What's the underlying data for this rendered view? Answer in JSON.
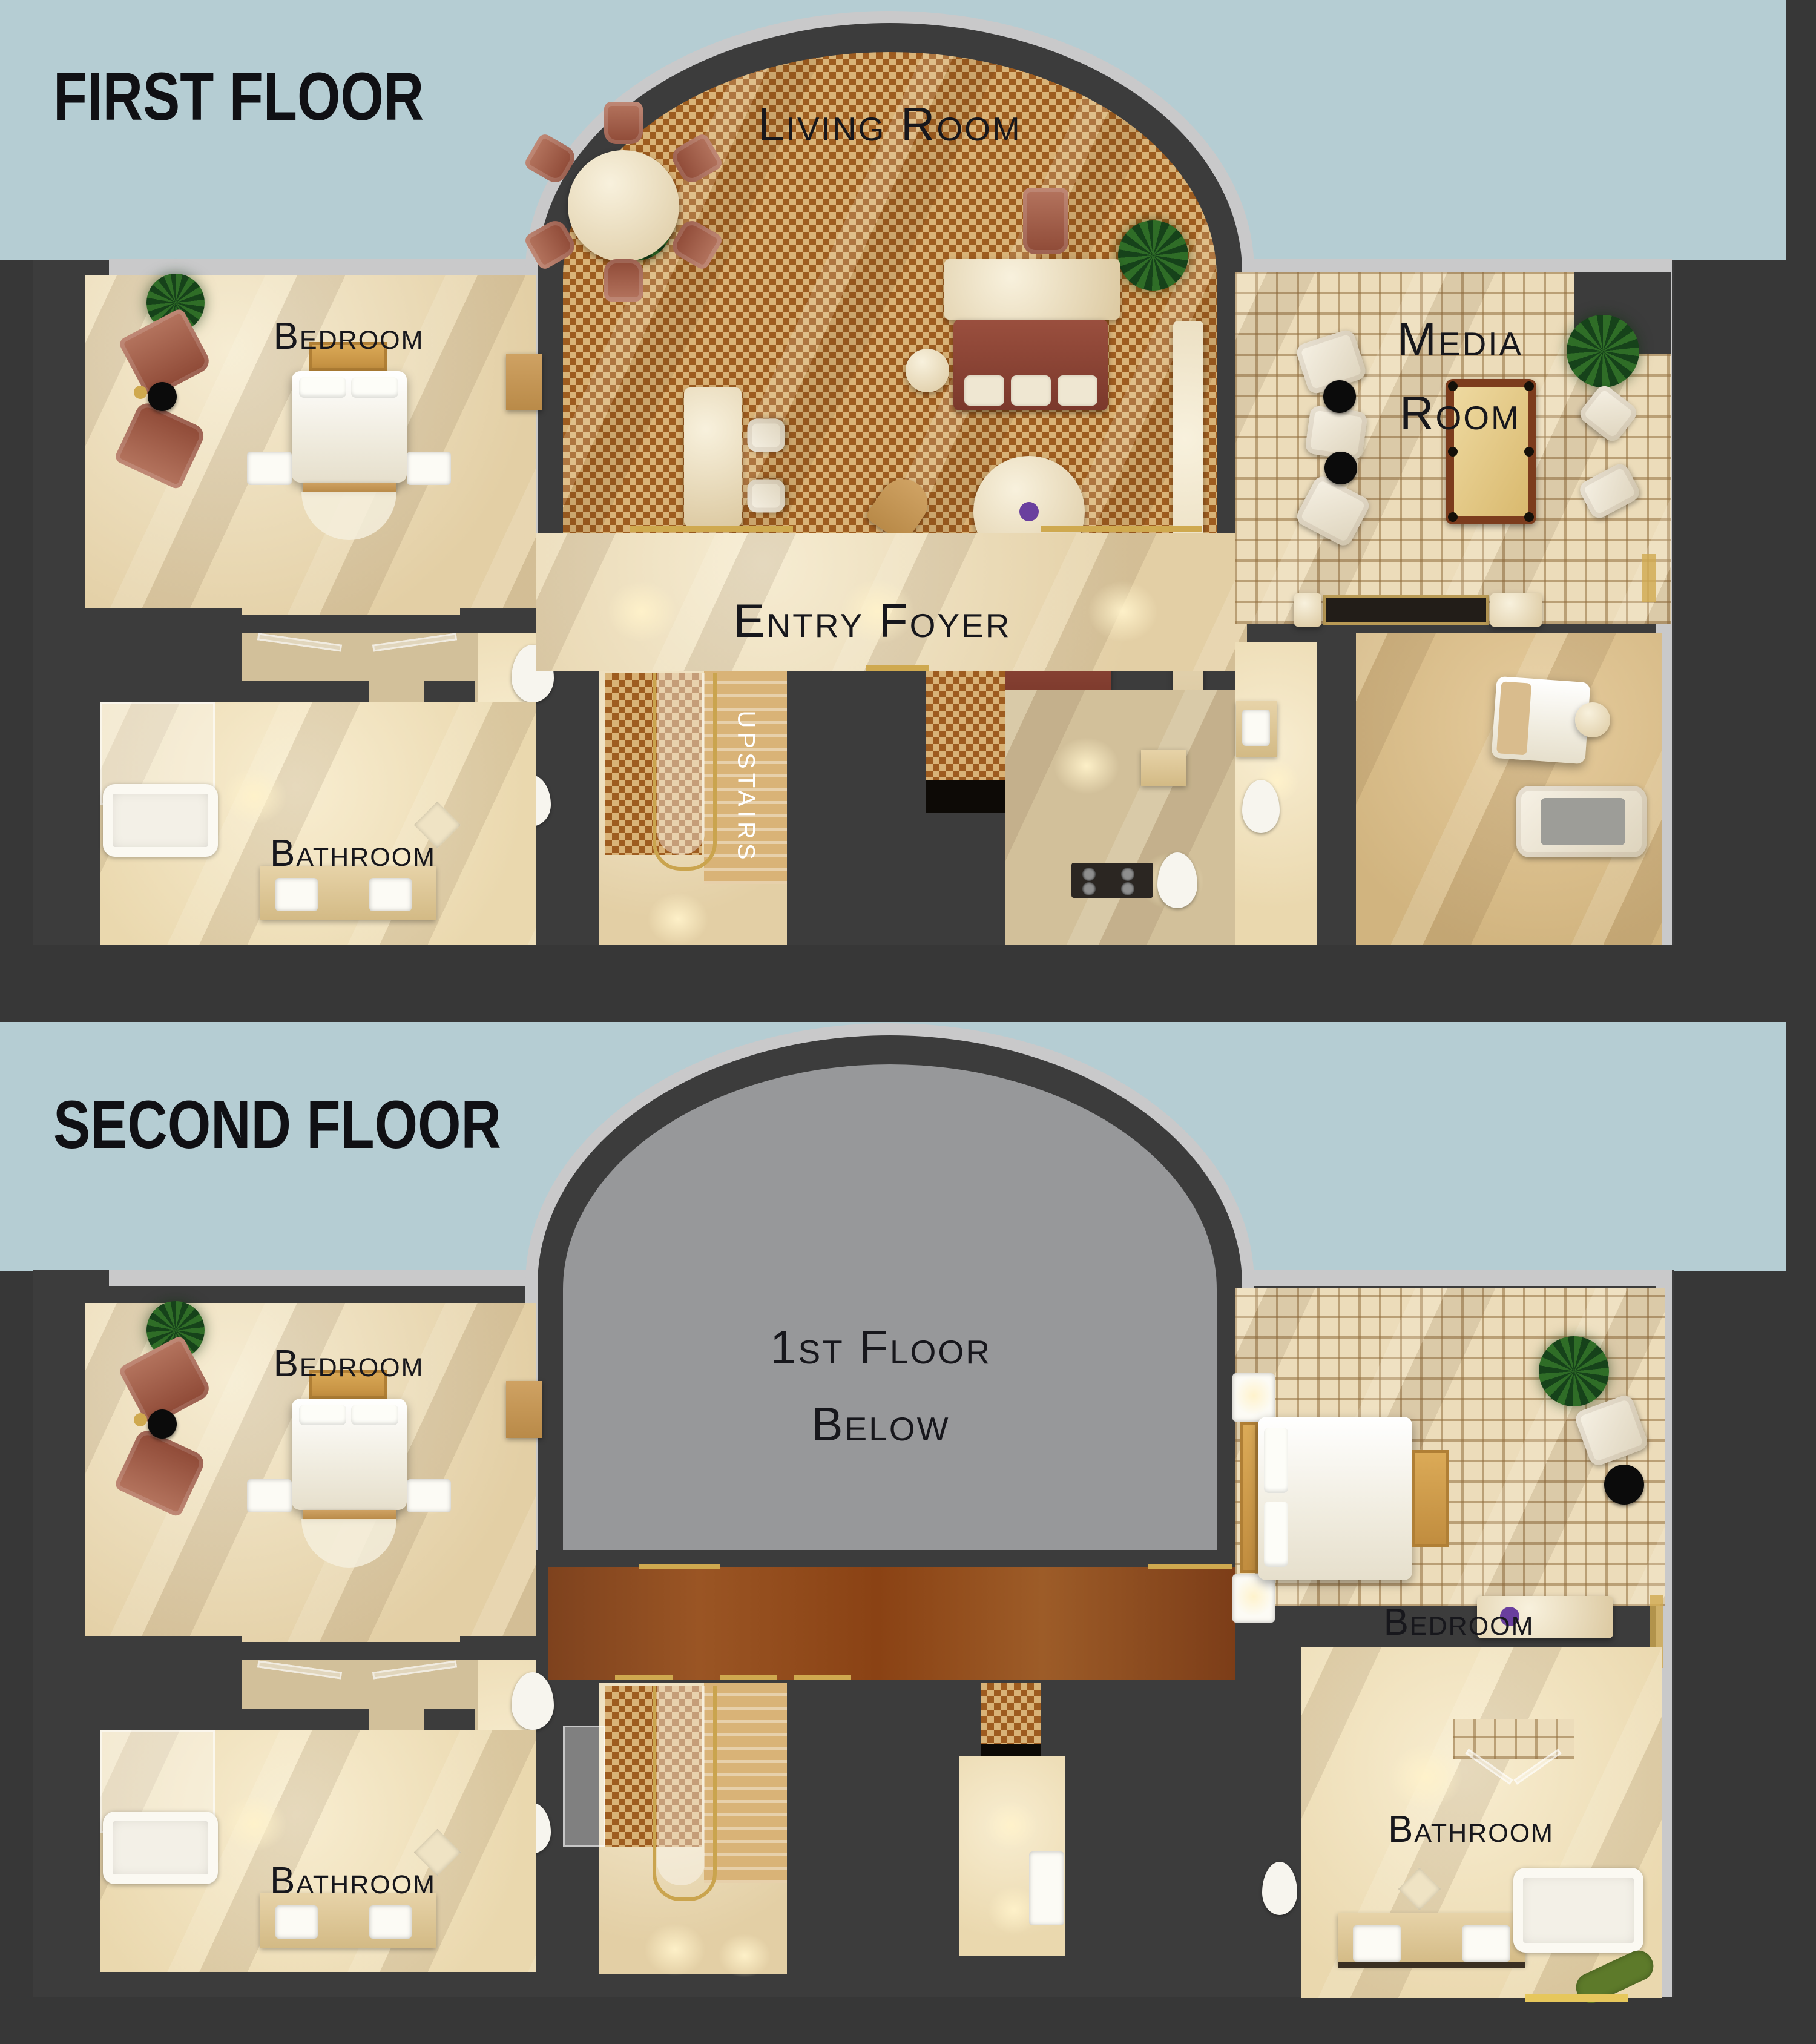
{
  "colors": {
    "background": "#373737",
    "sky_band": "#b5cdd3",
    "plan_outline": "#c9c9ca",
    "wall": "#3c3c3c",
    "void_fill": "#97989a",
    "houndstooth_base": "#d9b377",
    "houndstooth_ink": "#9e5c1f",
    "plaid_base": "#ecdcba",
    "plaid_line": "#a3855c",
    "floor_beige": "#eeddbb",
    "bath_beige": "#f4e7c8",
    "bridge_brown": "#8d4a1e",
    "sofa_maroon": "#8e4736",
    "gold": "#cfa94f",
    "label_ink": "#17171c",
    "upstairs_text_color": "#ffffff"
  },
  "first_floor": {
    "title": "FIRST FLOOR",
    "rooms": {
      "living_room": "Living Room",
      "bedroom": "Bedroom",
      "media_room": [
        "Media",
        "Room"
      ],
      "entry_foyer": "Entry Foyer",
      "bathroom": "Bathroom",
      "stairs": "UPSTAIRS"
    }
  },
  "second_floor": {
    "title": "SECOND FLOOR",
    "rooms": {
      "bedroom_left": "Bedroom",
      "open_to_below": [
        "1st Floor",
        "Below"
      ],
      "bedroom_right": "Bedroom",
      "bathroom_left": "Bathroom",
      "bathroom_right": "Bathroom"
    }
  }
}
